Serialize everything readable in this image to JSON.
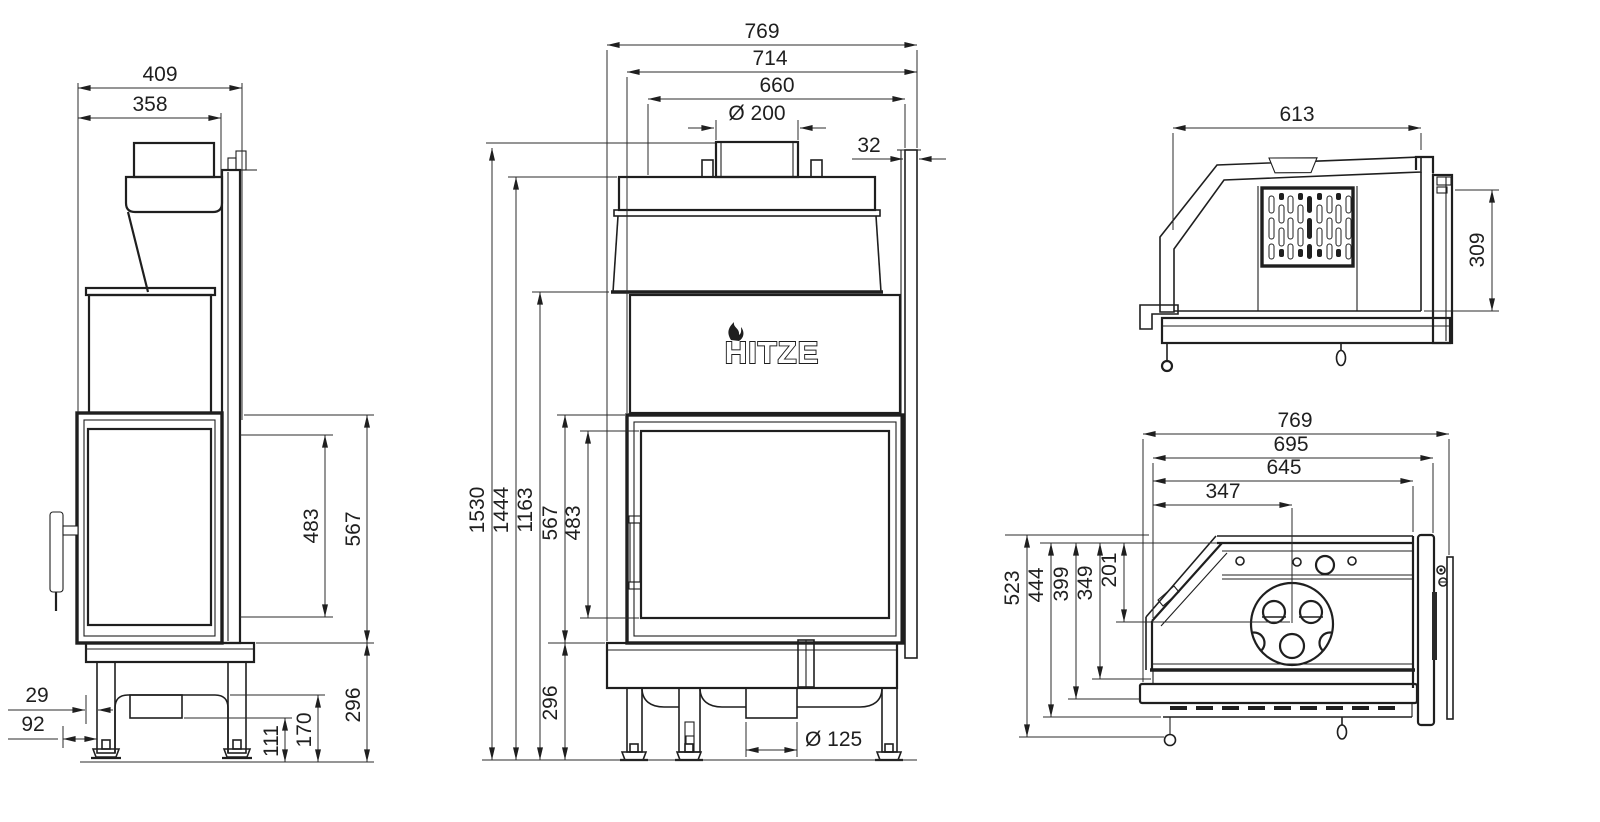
{
  "brand": {
    "logo_text": "HITZE"
  },
  "views": {
    "side": {
      "dims": {
        "overall_depth": "409",
        "upper_depth": "358",
        "glass_height": "483",
        "door_height": "567",
        "base_height": "296",
        "front_offset": "29",
        "handle_offset": "92",
        "recess_height": "111",
        "base_inner_height": "170"
      }
    },
    "front": {
      "dims": {
        "overall_width": "769",
        "body_width": "714",
        "top_width": "660",
        "flue_diameter": "Ø 200",
        "panel_offset": "32",
        "overall_height": "1530",
        "top_plate_height": "1444",
        "hood_height": "1163",
        "door_height": "567",
        "glass_height": "483",
        "base_height": "296",
        "outlet_diameter": "Ø 125"
      }
    },
    "rear_section": {
      "dims": {
        "width": "613",
        "depth": "309"
      }
    },
    "plan": {
      "dims": {
        "overall_width": "769",
        "body_width": "695",
        "firebox_width": "645",
        "flue_center_x": "347",
        "overall_depth": "523",
        "front_depth": "444",
        "rail_depth": "399",
        "glass_depth": "349",
        "flue_center_y": "201"
      }
    }
  }
}
